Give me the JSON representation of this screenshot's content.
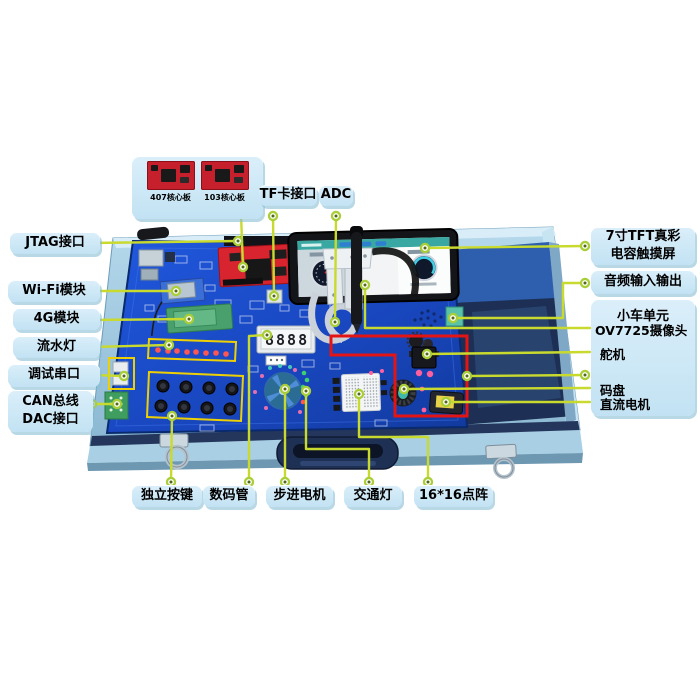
{
  "colors": {
    "leader_line": "#c9da2e",
    "node_ring": "#a9ce37",
    "label_bg": "#cde8f7",
    "highlight_red": "#e51414",
    "highlight_yellow": "#edcf05",
    "pcb_blue": "#1b50cf",
    "case_blue": "#9cc6de"
  },
  "core_board_panel": {
    "captions": [
      "407核心板",
      "103核心板"
    ]
  },
  "labels": {
    "tf_card": "TF卡接口",
    "adc": "ADC",
    "jtag": "JTAG接口",
    "wifi": "Wi-Fi模块",
    "g4": "4G模块",
    "led_flow": "流水灯",
    "debug_uart": "调试串口",
    "can_dac": "CAN总线\nDAC接口",
    "keys": "独立按键",
    "seven_seg": "数码管",
    "stepper": "步进电机",
    "traffic": "交通灯",
    "matrix": "16*16点阵",
    "tft": "7寸TFT真彩\n电容触摸屏",
    "audio": "音频输入输出",
    "car_unit": "小车单元",
    "camera": "OV7725摄像头",
    "servo": "舵机",
    "encoder": "码盘",
    "dc_motor": "直流电机"
  },
  "board": {
    "seven_segment_value": "8888"
  }
}
